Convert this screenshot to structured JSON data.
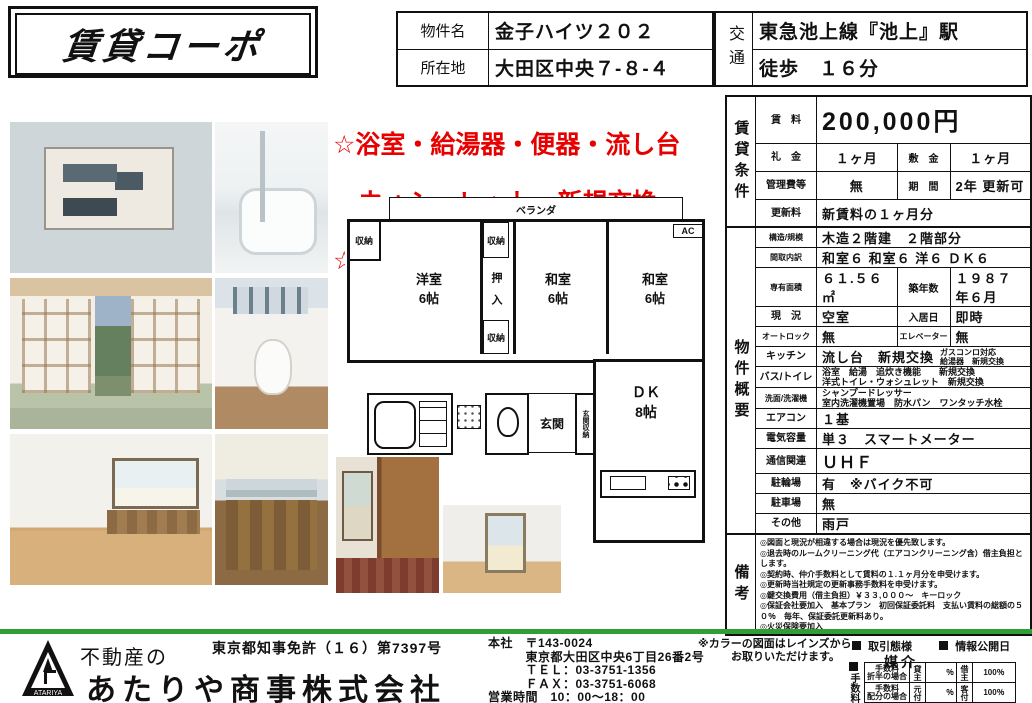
{
  "colors": {
    "accent_red": "#e60000",
    "divider_green": "#2f9e37"
  },
  "header": {
    "logo_title": "賃貸コーポ",
    "property_name_label": "物件名",
    "property_name": "金子ハイツ２０２",
    "address_label": "所在地",
    "address": "大田区中央７-８-４",
    "transport_label": "交通",
    "transport_line": "東急池上線『池上』駅",
    "transport_walk": "徒歩　１６分"
  },
  "highlight": {
    "line1": "☆浴室・給湯器・便器・流し台",
    "line2": "　ウォシュレット　新規交換",
    "line3": "☆ゆとりのある間取　３ＤＫ"
  },
  "photos": [
    "exterior",
    "bathroom",
    "japanese-room",
    "toilet",
    "kitchen-room",
    "kitchen-counter",
    "hallway",
    "bedroom"
  ],
  "floorplan": {
    "balcony": "ベランダ",
    "storage": "収納",
    "western_room": "洋室\n6帖",
    "closet": "押　入",
    "japanese_room1": "和室\n6帖",
    "japanese_room2": "和室\n6帖",
    "ac": "AC",
    "entrance": "玄関",
    "entrance_storage": "玄関収納",
    "dk": "ＤＫ\n8帖"
  },
  "conditions": {
    "section_label": "賃貸条件",
    "rent_label": "賃　料",
    "rent": "200,000円",
    "key_money_label": "礼　金",
    "key_money": "１ヶ月",
    "deposit_label": "敷　金",
    "deposit": "１ヶ月",
    "mgmt_fee_label": "管理費等",
    "mgmt_fee": "無",
    "term_label": "期　間",
    "term": "2年 更新可",
    "renewal_label": "更新料",
    "renewal": "新賃料の１ヶ月分"
  },
  "overview": {
    "section_label": "物件概要",
    "structure_label": "構造/規模",
    "structure": "木造２階建　２階部分",
    "layout_label": "間取内訳",
    "layout": "和室６ 和室６ 洋６ ＤＫ６",
    "area_label": "専有面積",
    "area": "６１.５６㎡",
    "age_label": "築年数",
    "age": "１９８７年６月",
    "status_label": "現　況",
    "status": "空室",
    "movein_label": "入居日",
    "movein": "即時",
    "autolock_label": "オートロック",
    "autolock": "無",
    "elevator_label": "エレベーター",
    "elevator": "無",
    "kitchen_label": "キッチン",
    "kitchen": "流し台　新規交換",
    "kitchen_extra": "ガスコンロ対応\n給湯器　新規交換",
    "bath_label": "バス/トイレ",
    "bath": "浴室　給湯　追炊き機能　　新規交換\n洋式トイレ・ウォシュレット　新規交換",
    "laundry_label": "洗面/洗濯機",
    "laundry": "シャンプードレッサー\n室内洗濯機置場　防水パン　ワンタッチ水栓",
    "aircon_label": "エアコン",
    "aircon": "１基",
    "electric_label": "電気容量",
    "electric": "単３　スマートメーター",
    "telecom_label": "通信関連",
    "telecom": "ＵＨＦ",
    "bicycle_label": "駐輪場",
    "bicycle": "有　※バイク不可",
    "parking_label": "駐車場",
    "parking": "無",
    "other_label": "その他",
    "other": "雨戸"
  },
  "remarks": {
    "section_label": "備考",
    "lines": [
      "◎図面と現況が相違する場合は現況を優先致します。",
      "◎退去時のルームクリーニング代（エアコンクリーニング含）借主負担とします。",
      "◎契約時、仲介手数料として賃料の１.１ヶ月分を申受けます。",
      "◎更新時当社規定の更新事務手数料を申受けます。",
      "◎鍵交換費用（借主負担）￥３３,０００～　キーロック",
      "◎保証会社要加入　基本プラン　初回保証委託料　支払い賃料の総額の５０％　毎年、保証委託更新料あり。",
      "◎火災保険要加入"
    ]
  },
  "footer": {
    "company_prefix": "不動産の",
    "company_name": "あたりや商事株式会社",
    "logo_text": "ATARIYA",
    "license": "東京都知事免許（１６）第7397号",
    "office_lines": [
      "本社　〒143-0024",
      "　　　東京都大田区中央6丁目26番2号",
      "　　　ＴＥＬ：03-3751-1356",
      "　　　ＦＡＸ：03-3751-6068",
      "営業時間　10：00～18：00",
      "定休日　　毎週水曜日、第3週のみ水木曜日"
    ],
    "color_note": "※カラーの図面はレインズから\n　　　お取りいただけます。",
    "deal_type_label": "取引態様",
    "deal_type": "媒介",
    "info_date_label": "情報公開日",
    "fee_label": "手数料",
    "fee_rows": [
      {
        "case": "手数料\n折半の場合",
        "p1": "貸主",
        "v1": "％",
        "p2": "借主",
        "v2": "100％"
      },
      {
        "case": "手数料\n配分の場合",
        "p1": "元付",
        "v1": "％",
        "p2": "客付",
        "v2": "100％"
      }
    ]
  }
}
